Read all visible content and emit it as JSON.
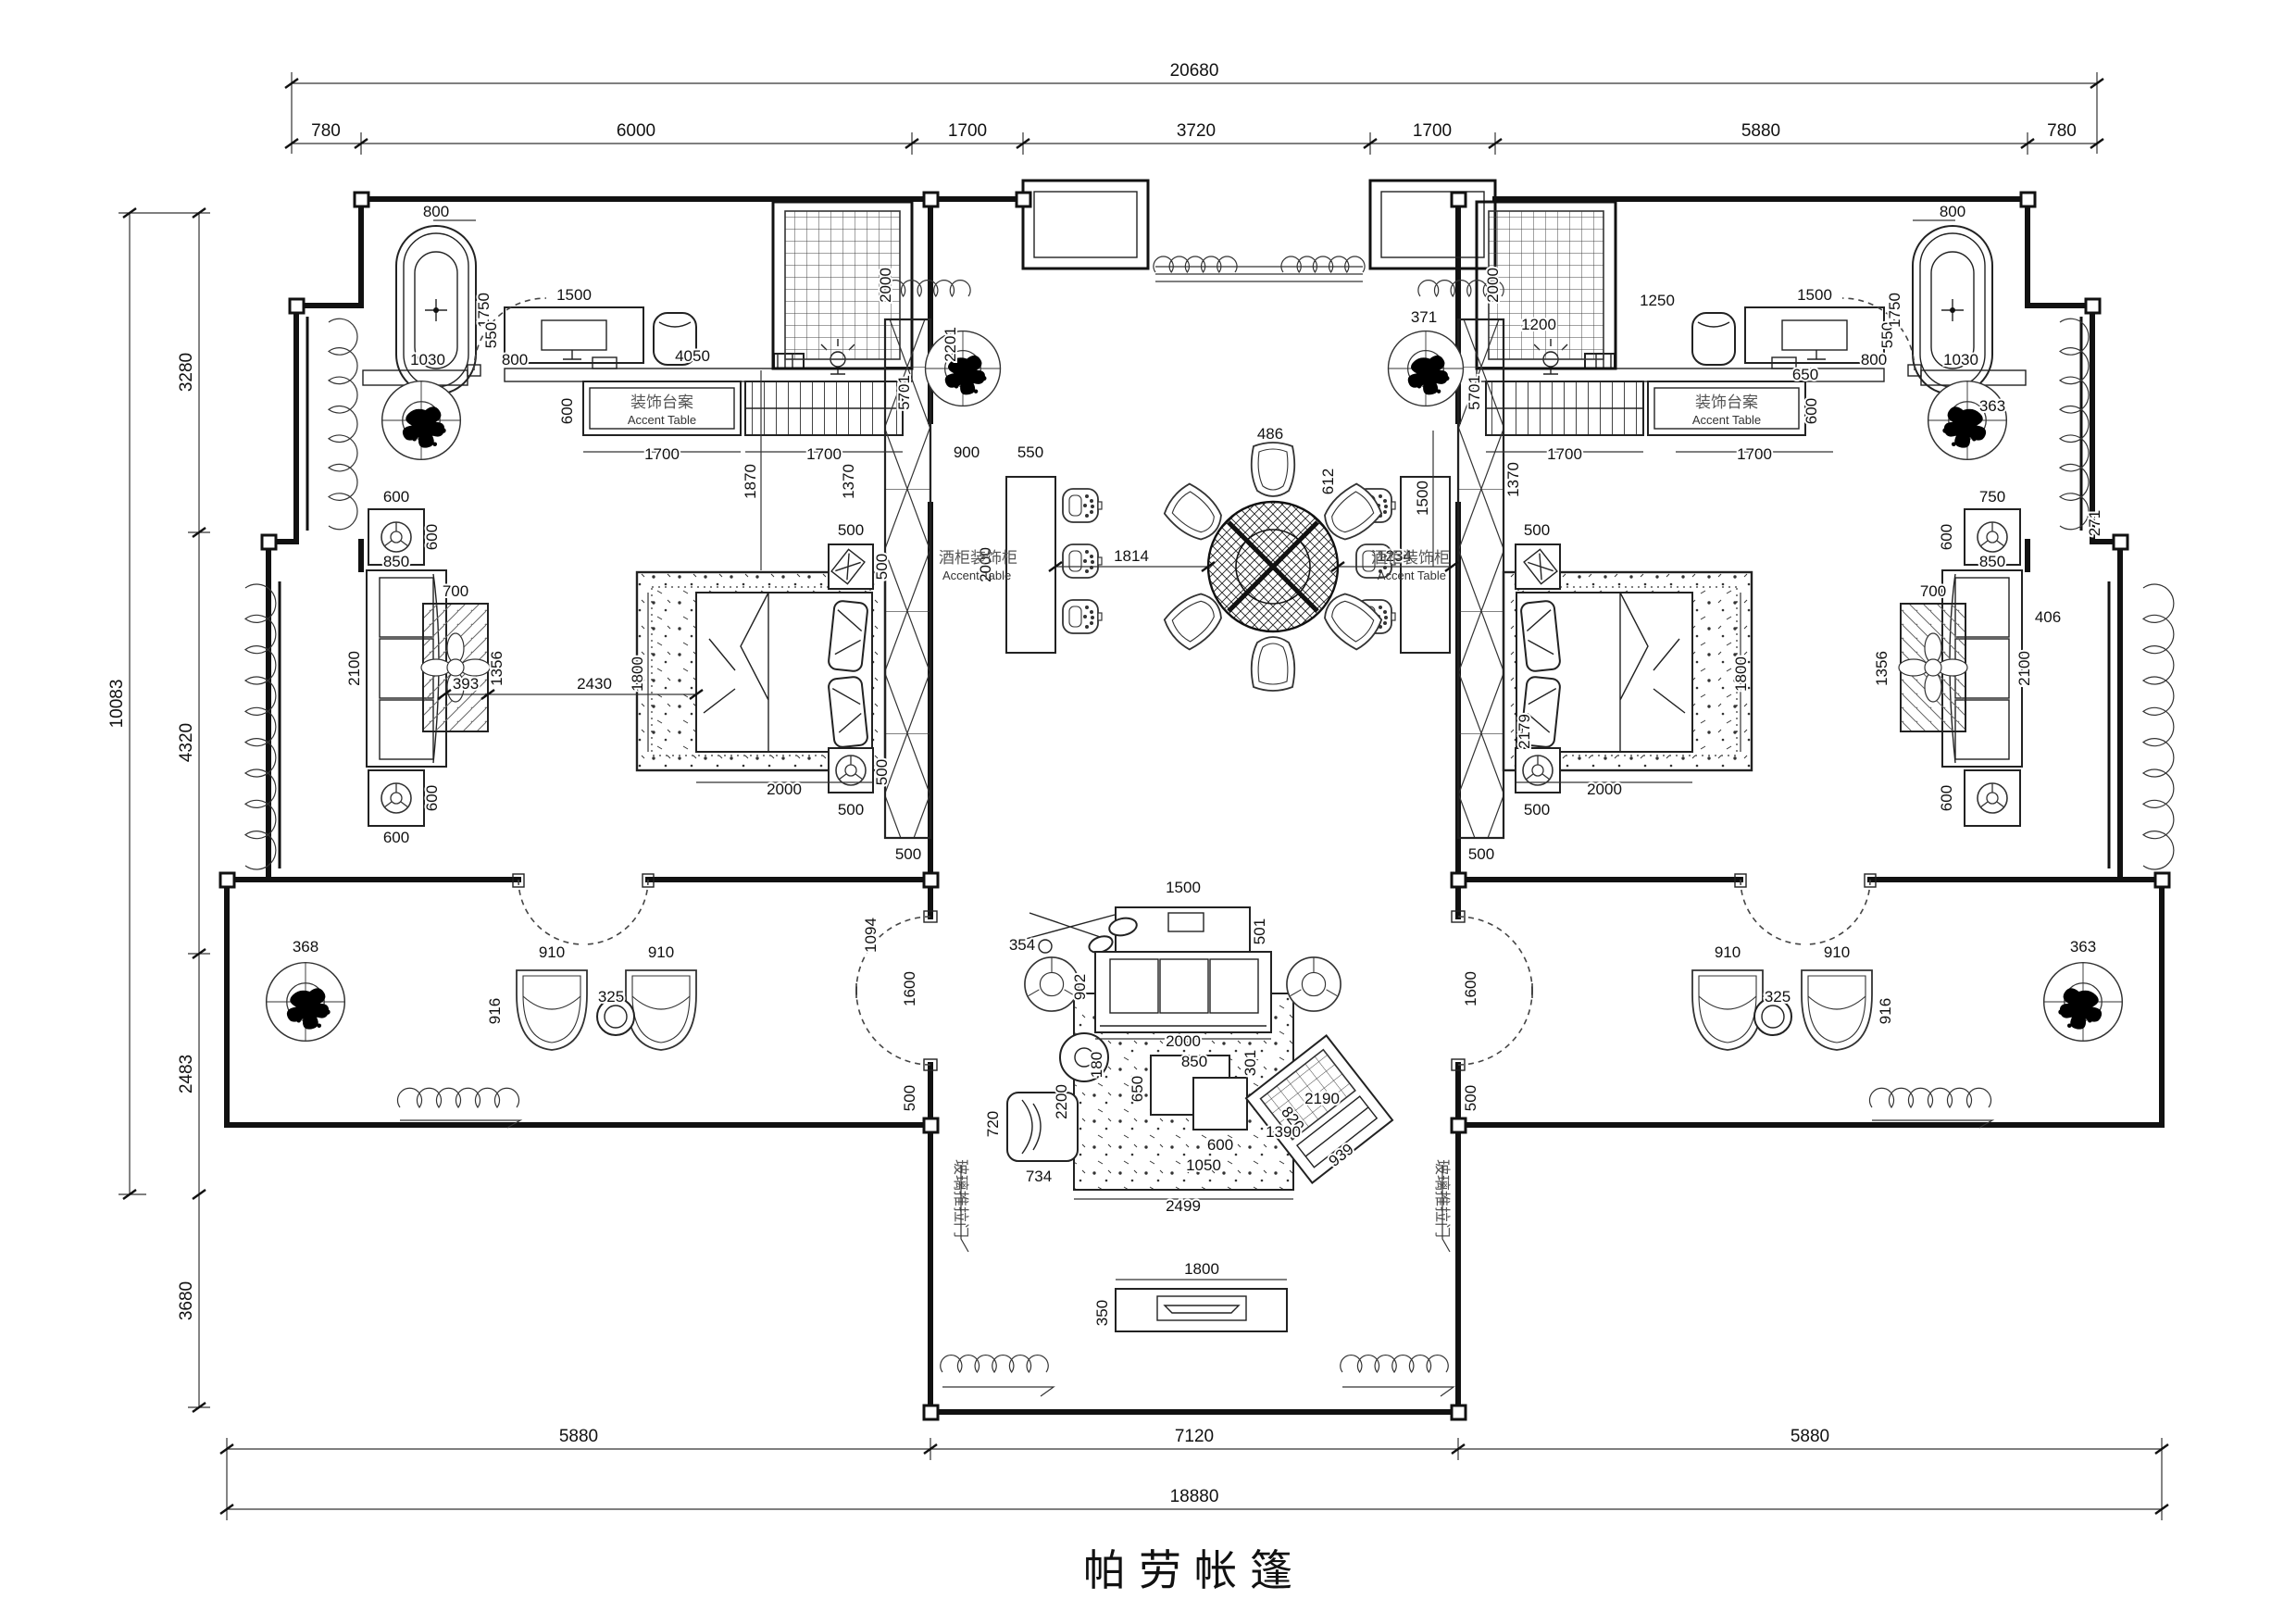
{
  "title": "帕劳帐篷",
  "labels": {
    "accent_table_zh": "装饰台案",
    "accent_table_en": "Accent Table",
    "wine_cabinet_zh": "酒柜装饰柜",
    "wine_cabinet_en": "Accent Table",
    "glass_door": "玻璃推拉门"
  },
  "dims": {
    "topTotal": "20680",
    "top": [
      "780",
      "6000",
      "1700",
      "3720",
      "1700",
      "5880",
      "780"
    ],
    "leftTotal": "10083",
    "left": [
      "3280",
      "4320",
      "2483",
      "3680"
    ],
    "bottom": [
      "5880",
      "7120",
      "5880"
    ],
    "bottomTotal": "18880",
    "lbath": {
      "tubW": "800",
      "tubH": "1750",
      "n1030": "1030",
      "n800": "800",
      "deskD": "550",
      "deskW": "1500",
      "n4050": "4050",
      "shower": "2000",
      "accD": "600",
      "accW": "1700",
      "wardW": "1700"
    },
    "rbath": {
      "plant": "371",
      "lamp": "1200",
      "shower": "2000",
      "chair": "1250",
      "deskW": "1500",
      "n650": "650",
      "deskD": "550",
      "n800": "800",
      "n1030": "1030",
      "tubW": "800",
      "tubH": "1750",
      "plant2": "363",
      "accD": "600",
      "accW": "1700",
      "wardW": "1700"
    },
    "center": {
      "corr": "2201",
      "n900": "900",
      "n550": "550",
      "bar": "2000",
      "wine": "5701",
      "wineW": "500",
      "c486": "486",
      "c612": "612",
      "d1814": "1814",
      "d1234": "1234",
      "d1500": "1500",
      "wineR": "5701",
      "wineRW": "500",
      "r1370": "1370",
      "r2179": "2179"
    },
    "lbed": {
      "v1870": "1870",
      "v1370": "1370",
      "ns1": "500",
      "ns2": "500",
      "bedL": "2000",
      "bedW": "1800",
      "ns3": "500",
      "ns4": "500",
      "v1094": "1094",
      "g393": "393",
      "g2430": "2430",
      "rugW": "700",
      "rugH": "1356",
      "sofa": "2100",
      "et1": "600",
      "et2": "600",
      "et3": "600",
      "et4": "600",
      "et5": "850"
    },
    "rbed": {
      "ns1": "500",
      "ns2": "500",
      "bedL": "2000",
      "bedW": "1800",
      "rugW": "700",
      "rugH": "1356",
      "n406": "406",
      "n750": "750",
      "sofa": "2100",
      "et1": "600",
      "et2": "600",
      "et5": "850",
      "n271": "271"
    },
    "lterr": {
      "plant": "368",
      "ch1": "910",
      "tbl": "325",
      "ch2": "910",
      "v916": "916",
      "door": "1600",
      "n500": "500"
    },
    "rterr": {
      "plant": "363",
      "ch1": "910",
      "tbl": "325",
      "ch2": "910",
      "v916": "916",
      "door": "1600",
      "n500": "500"
    },
    "living": {
      "console": "1500",
      "n501": "501",
      "n902": "902",
      "n354": "354",
      "sofa": "2000",
      "n850": "850",
      "n301": "301",
      "n180": "180",
      "rugH": "2200",
      "n650": "650",
      "n600": "600",
      "n1050": "1050",
      "n820": "820",
      "n939": "939",
      "n734": "734",
      "n720": "720",
      "rugW": "2499",
      "n2190": "2190",
      "n1390": "1390"
    },
    "deck": {
      "bench": "1800",
      "benchD": "350"
    }
  }
}
